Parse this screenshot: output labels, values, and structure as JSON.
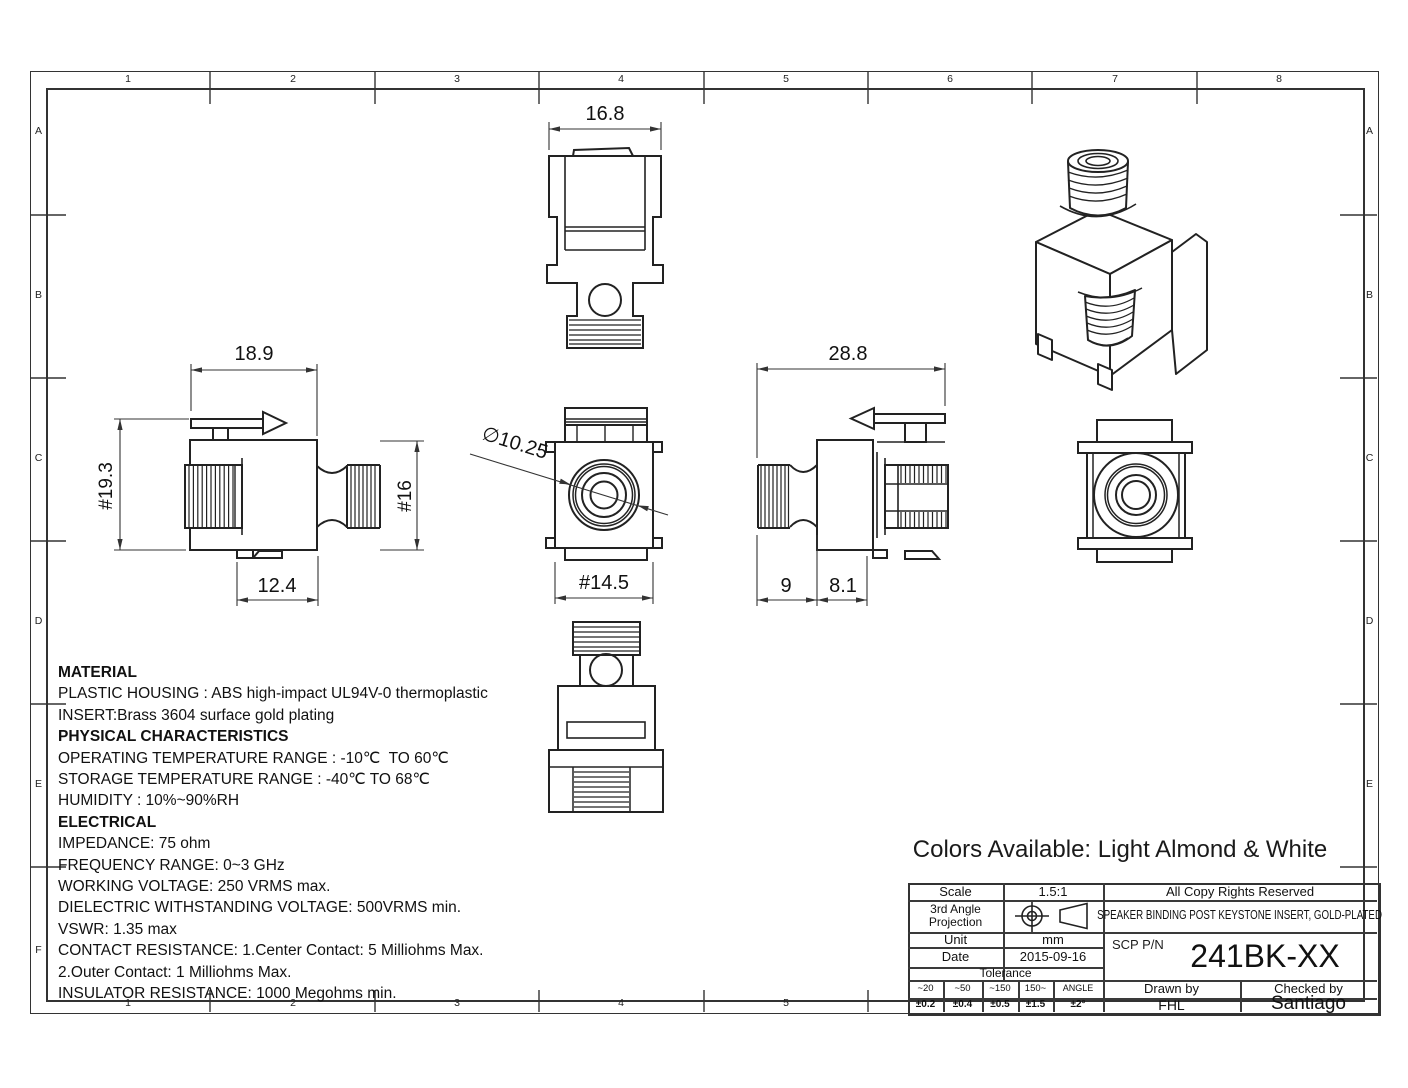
{
  "border": {
    "cols": [
      "1",
      "2",
      "3",
      "4",
      "5",
      "6",
      "7",
      "8"
    ],
    "rows": [
      "A",
      "B",
      "C",
      "D",
      "E",
      "F"
    ]
  },
  "dimensions": {
    "top_view_width": "16.8",
    "side_left_width": "18.9",
    "side_left_height": "#19.3",
    "side_left_inner_height": "#16",
    "side_left_bottom": "12.4",
    "front_diameter": "∅10.25",
    "front_width": "#14.5",
    "side_right_width": "28.8",
    "side_right_d1": "9",
    "side_right_d2": "8.1"
  },
  "notes": {
    "lines": [
      {
        "text": "MATERIAL",
        "bold": true
      },
      {
        "text": "PLASTIC HOUSING : ABS high-impact UL94V-0 thermoplastic",
        "bold": false
      },
      {
        "text": "INSERT:Brass 3604 surface gold plating",
        "bold": false
      },
      {
        "text": "PHYSICAL CHARACTERISTICS",
        "bold": true
      },
      {
        "text": "OPERATING TEMPERATURE RANGE : -10℃  TO 60℃",
        "bold": false
      },
      {
        "text": "STORAGE TEMPERATURE RANGE : -40℃ TO 68℃",
        "bold": false
      },
      {
        "text": "HUMIDITY : 10%~90%RH",
        "bold": false
      },
      {
        "text": "ELECTRICAL",
        "bold": true
      },
      {
        "text": "IMPEDANCE: 75 ohm",
        "bold": false
      },
      {
        "text": "FREQUENCY RANGE: 0~3 GHz",
        "bold": false
      },
      {
        "text": "WORKING VOLTAGE: 250 VRMS max.",
        "bold": false
      },
      {
        "text": "DIELECTRIC WITHSTANDING VOLTAGE: 500VRMS min.",
        "bold": false
      },
      {
        "text": "VSWR: 1.35 max",
        "bold": false
      },
      {
        "text": "CONTACT RESISTANCE: 1.Center Contact: 5 Milliohms Max.",
        "bold": false
      },
      {
        "text": "2.Outer Contact: 1 Milliohms Max.",
        "bold": false
      },
      {
        "text": "INSULATOR RESISTANCE: 1000 Megohms min.",
        "bold": false
      }
    ]
  },
  "colors_note": "Colors Available: Light Almond & White",
  "title_block": {
    "scale_label": "Scale",
    "scale_value": "1.5:1",
    "copyright": "All Copy Rights Reserved",
    "projection_line1": "3rd Angle",
    "projection_line2": "Projection",
    "title": "SPEAKER BINDING POST KEYSTONE INSERT, GOLD-PLATED",
    "unit_label": "Unit",
    "unit_value": "mm",
    "date_label": "Date",
    "date_value": "2015-09-16",
    "tolerance_label": "Tolerance",
    "tol_headers": [
      "~20",
      "~50",
      "~150",
      "150~",
      "ANGLE"
    ],
    "tol_values": [
      "±0.2",
      "±0.4",
      "±0.5",
      "±1.5",
      "±2°"
    ],
    "pn_label": "SCP P/N",
    "part_number": "241BK-XX",
    "drawn_label": "Drawn by",
    "drawn_value": "FHL",
    "checked_label": "Checked by",
    "checked_value": "Santiago"
  }
}
